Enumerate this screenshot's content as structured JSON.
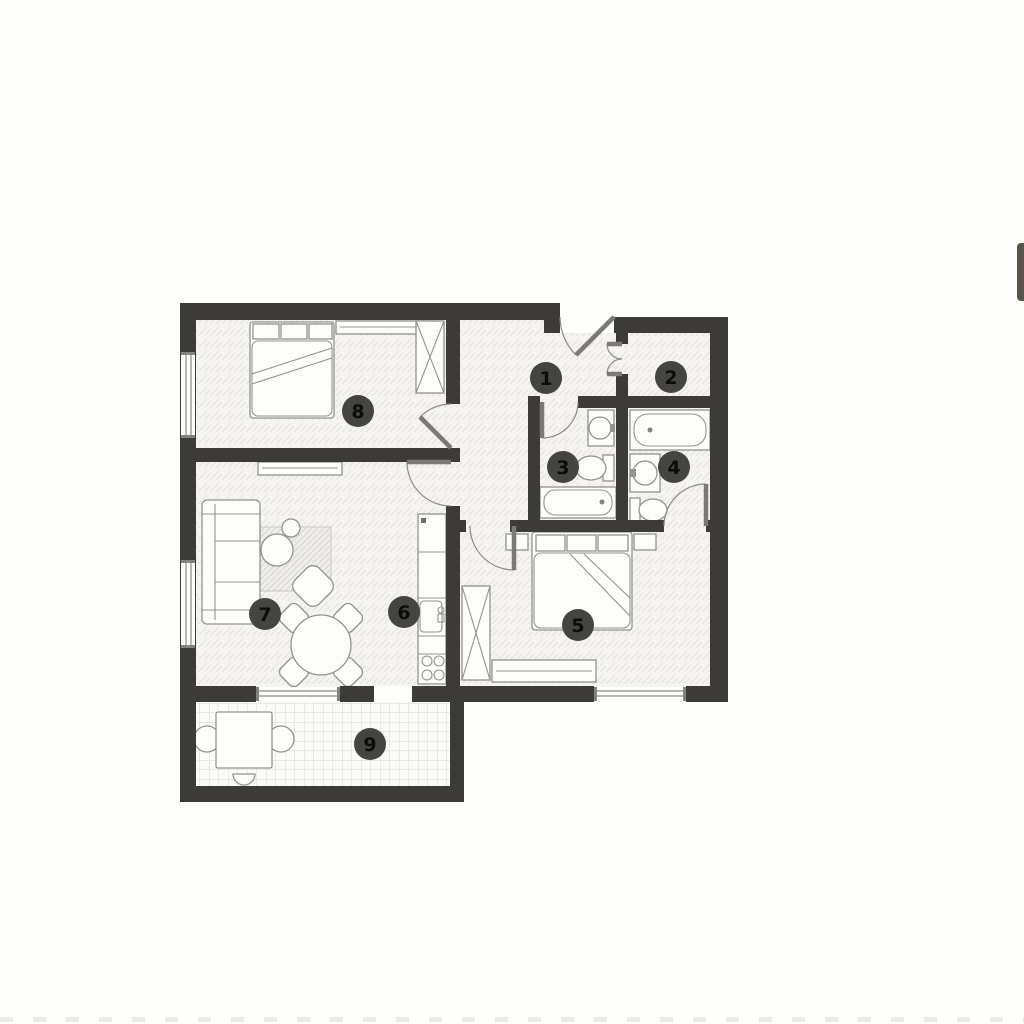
{
  "plan": {
    "room_labels": [
      "1",
      "2",
      "3",
      "4",
      "5",
      "6",
      "7",
      "8",
      "9"
    ]
  },
  "colors": {
    "wall": "#3d3b37",
    "marker_circle": "#454440",
    "marker_text": "#0c0c0c",
    "floor": "#f5f4f1",
    "balcony_floor": "#fbfbf9"
  }
}
